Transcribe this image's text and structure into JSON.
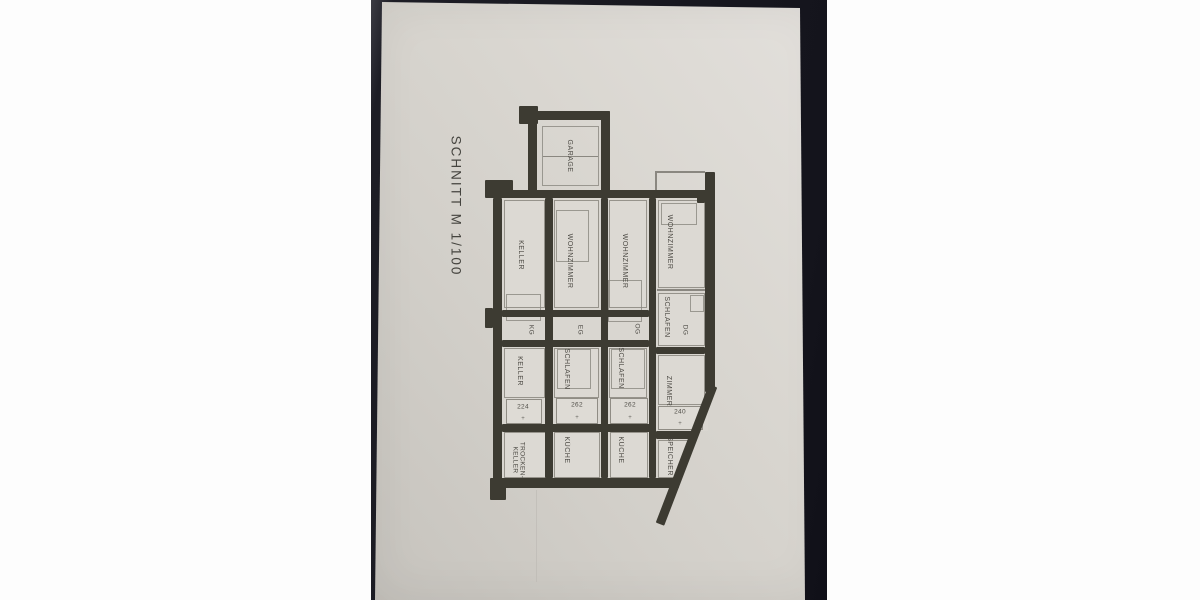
{
  "drawing": {
    "title": "SCHNITT M 1/100",
    "garage": {
      "label": "GARAGE"
    },
    "floors": [
      {
        "code": "KG",
        "dim": "224",
        "rooms": {
          "top": "KELLER",
          "mid": "KELLER",
          "bottom": "TROCKEN-KELLER"
        }
      },
      {
        "code": "EG",
        "dim": "262",
        "rooms": {
          "top": "WOHNZIMMER",
          "mid": "SCHLAFEN",
          "bottom": "KÜCHE"
        }
      },
      {
        "code": "OG",
        "dim": "262",
        "rooms": {
          "top": "WOHNZIMMER",
          "mid": "SCHLAFEN",
          "bottom": "KÜCHE"
        }
      },
      {
        "code": "DG",
        "dim": "240",
        "rooms": {
          "top": "WOHNZIMMER",
          "mid": "SCHLAFEN",
          "extra": "ZIMMER",
          "bottom": "SPEICHER"
        }
      }
    ],
    "dim_tick": "+",
    "colors": {
      "canvas": "#fdfdfd",
      "photo_background": "#17171f",
      "paper": "#d6d3cd",
      "wall": "#3d3b32",
      "thin_line": "#8a8780",
      "text": "#3f3d37"
    }
  }
}
